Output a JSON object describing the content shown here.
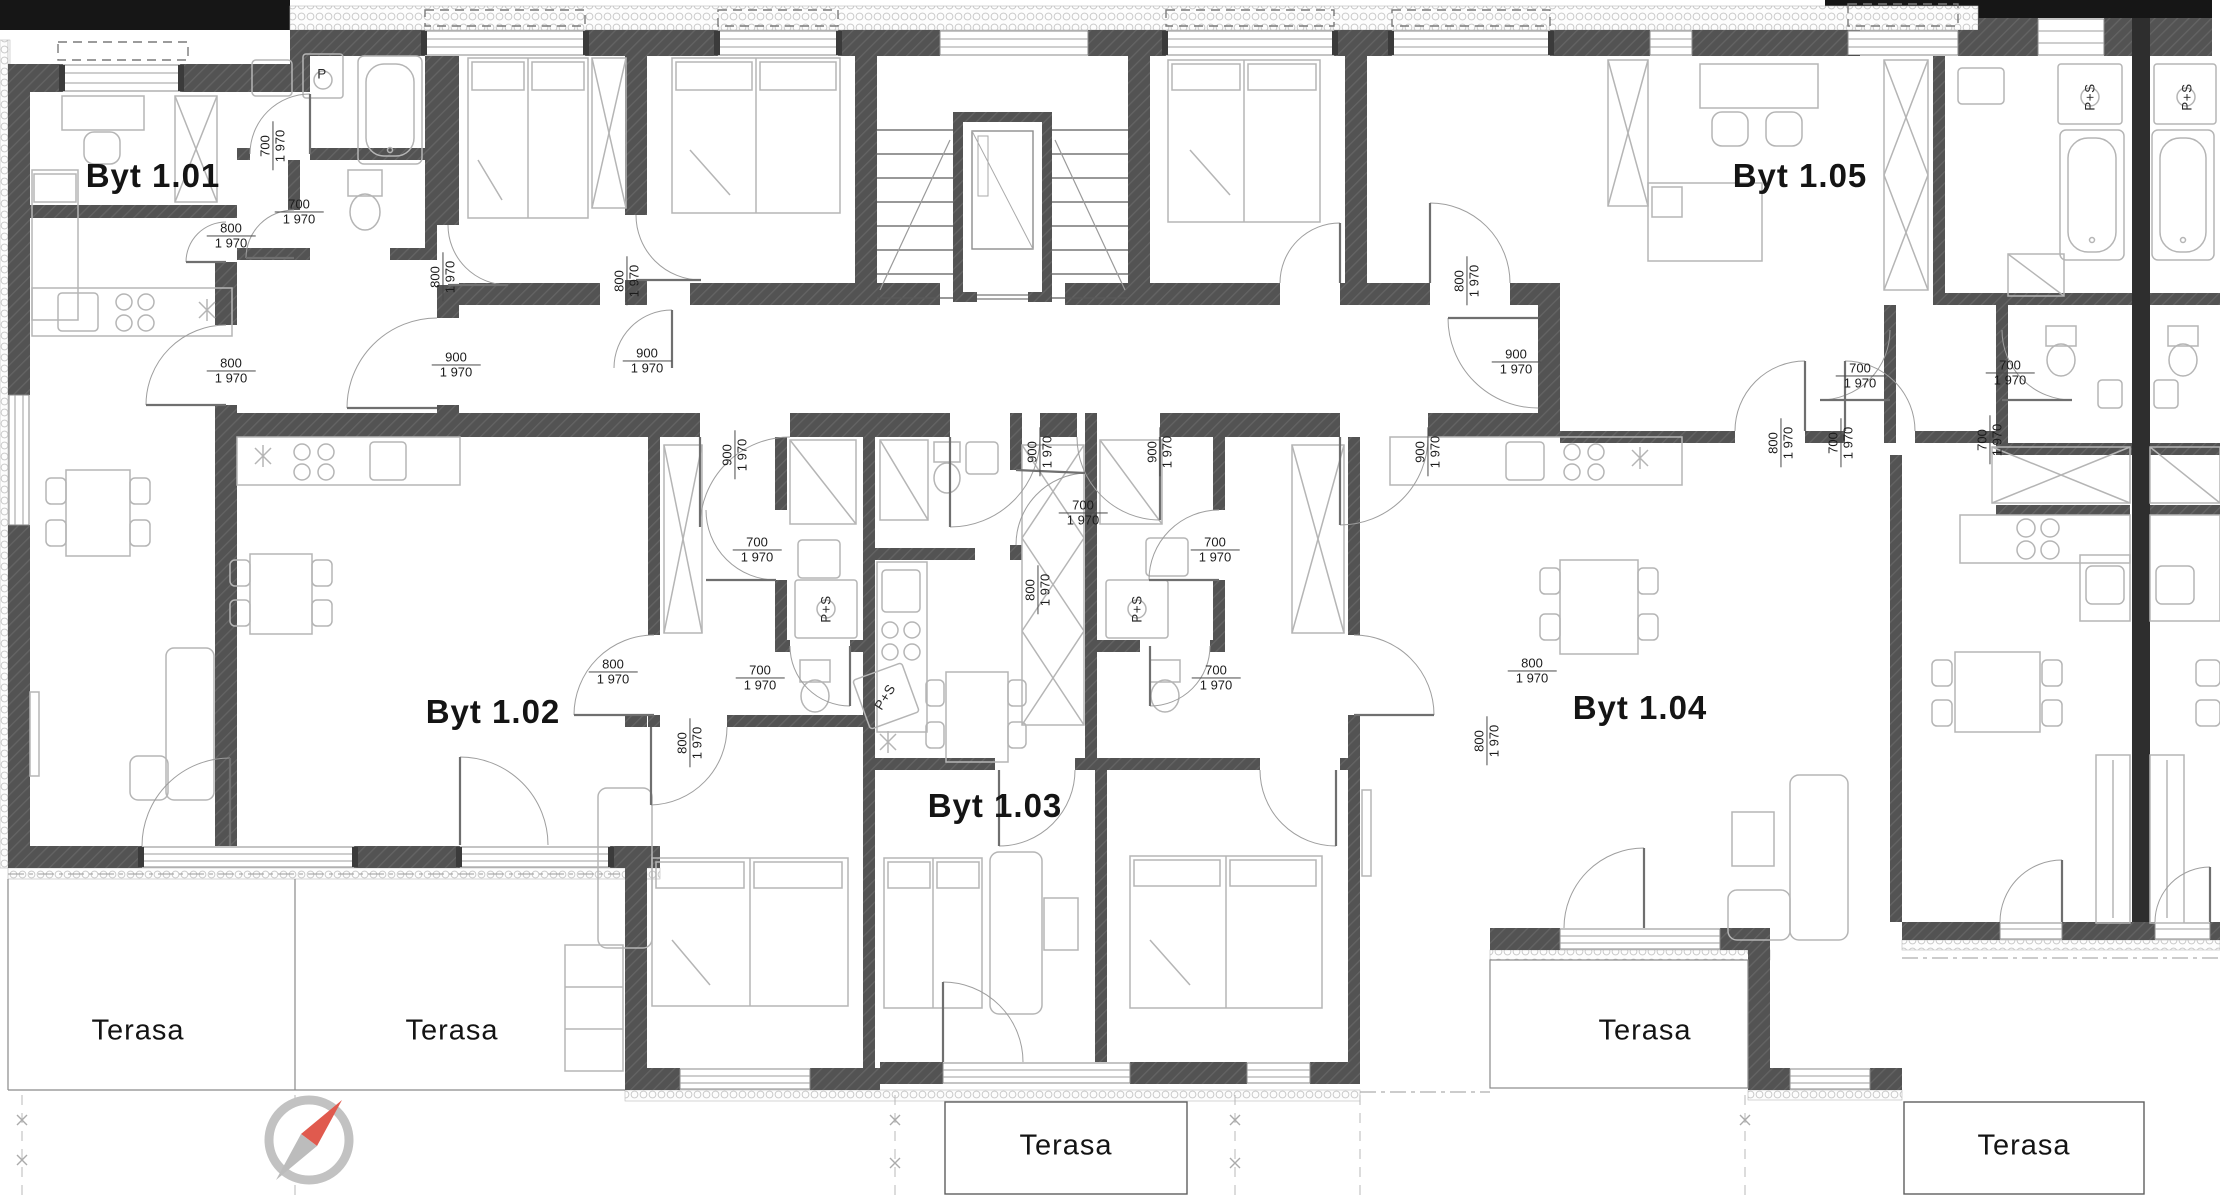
{
  "plan": {
    "apartment_labels": [
      {
        "text": "Byt 1.01",
        "x": 153,
        "y": 176
      },
      {
        "text": "Byt 1.02",
        "x": 493,
        "y": 712
      },
      {
        "text": "Byt 1.03",
        "x": 995,
        "y": 806
      },
      {
        "text": "Byt 1.04",
        "x": 1640,
        "y": 708
      },
      {
        "text": "Byt 1.05",
        "x": 1800,
        "y": 176
      }
    ],
    "terrace_labels": [
      {
        "text": "Terasa",
        "x": 138,
        "y": 1031
      },
      {
        "text": "Terasa",
        "x": 452,
        "y": 1031
      },
      {
        "text": "Terasa",
        "x": 1066,
        "y": 1146
      },
      {
        "text": "Terasa",
        "x": 1645,
        "y": 1031
      },
      {
        "text": "Terasa",
        "x": 2024,
        "y": 1146
      }
    ],
    "door_dimension_labels": [
      {
        "top": "700",
        "bottom": "1 970",
        "x": 273,
        "y": 146,
        "orient": "v"
      },
      {
        "top": "700",
        "bottom": "1 970",
        "x": 299,
        "y": 212,
        "orient": "h"
      },
      {
        "top": "800",
        "bottom": "1 970",
        "x": 231,
        "y": 236,
        "orient": "h"
      },
      {
        "top": "800",
        "bottom": "1 970",
        "x": 443,
        "y": 277,
        "orient": "v"
      },
      {
        "top": "800",
        "bottom": "1 970",
        "x": 231,
        "y": 371,
        "orient": "h"
      },
      {
        "top": "900",
        "bottom": "1 970",
        "x": 456,
        "y": 365,
        "orient": "h"
      },
      {
        "top": "800",
        "bottom": "1 970",
        "x": 627,
        "y": 281,
        "orient": "v"
      },
      {
        "top": "900",
        "bottom": "1 970",
        "x": 647,
        "y": 361,
        "orient": "h"
      },
      {
        "top": "900",
        "bottom": "1 970",
        "x": 735,
        "y": 455,
        "orient": "v"
      },
      {
        "top": "900",
        "bottom": "1 970",
        "x": 1040,
        "y": 452,
        "orient": "v"
      },
      {
        "top": "900",
        "bottom": "1 970",
        "x": 1160,
        "y": 452,
        "orient": "v"
      },
      {
        "top": "900",
        "bottom": "1 970",
        "x": 1428,
        "y": 452,
        "orient": "v"
      },
      {
        "top": "800",
        "bottom": "1 970",
        "x": 1467,
        "y": 281,
        "orient": "v"
      },
      {
        "top": "900",
        "bottom": "1 970",
        "x": 1516,
        "y": 362,
        "orient": "h"
      },
      {
        "top": "800",
        "bottom": "1 970",
        "x": 1781,
        "y": 443,
        "orient": "v"
      },
      {
        "top": "700",
        "bottom": "1 970",
        "x": 1841,
        "y": 443,
        "orient": "v"
      },
      {
        "top": "700",
        "bottom": "1 970",
        "x": 2010,
        "y": 373,
        "orient": "h"
      },
      {
        "top": "700",
        "bottom": "1 970",
        "x": 1990,
        "y": 440,
        "orient": "v"
      },
      {
        "top": "700",
        "bottom": "1 970",
        "x": 757,
        "y": 550,
        "orient": "h"
      },
      {
        "top": "700",
        "bottom": "1 970",
        "x": 760,
        "y": 678,
        "orient": "h"
      },
      {
        "top": "800",
        "bottom": "1 970",
        "x": 613,
        "y": 672,
        "orient": "h"
      },
      {
        "top": "800",
        "bottom": "1 970",
        "x": 690,
        "y": 743,
        "orient": "v"
      },
      {
        "top": "700",
        "bottom": "1 970",
        "x": 1083,
        "y": 513,
        "orient": "h"
      },
      {
        "top": "800",
        "bottom": "1 970",
        "x": 1038,
        "y": 590,
        "orient": "v"
      },
      {
        "top": "700",
        "bottom": "1 970",
        "x": 1215,
        "y": 550,
        "orient": "h"
      },
      {
        "top": "700",
        "bottom": "1 970",
        "x": 1216,
        "y": 678,
        "orient": "h"
      },
      {
        "top": "800",
        "bottom": "1 970",
        "x": 1532,
        "y": 671,
        "orient": "h"
      },
      {
        "top": "800",
        "bottom": "1 970",
        "x": 1487,
        "y": 741,
        "orient": "v"
      },
      {
        "top": "700",
        "bottom": "1 970",
        "x": 1860,
        "y": 376,
        "orient": "h"
      }
    ],
    "appliance_labels": [
      {
        "text": "P",
        "x": 322,
        "y": 74,
        "orient": "h"
      },
      {
        "text": "P+S",
        "x": 826,
        "y": 609,
        "orient": "v"
      },
      {
        "text": "P+S",
        "x": 885,
        "y": 697,
        "orient": "d"
      },
      {
        "text": "P+S",
        "x": 1137,
        "y": 609,
        "orient": "v"
      },
      {
        "text": "P+S",
        "x": 2090,
        "y": 97,
        "orient": "v"
      },
      {
        "text": "P+S",
        "x": 2187,
        "y": 97,
        "orient": "v"
      }
    ],
    "compass": {
      "x": 309,
      "y": 1140
    },
    "colors": {
      "wall": "#4f4f4f",
      "black_mass": "#161616",
      "fixture_line": "#b5b5b5",
      "needle_red": "#e05a4e",
      "needle_gray": "#bcbcbc",
      "text": "#141414"
    }
  }
}
